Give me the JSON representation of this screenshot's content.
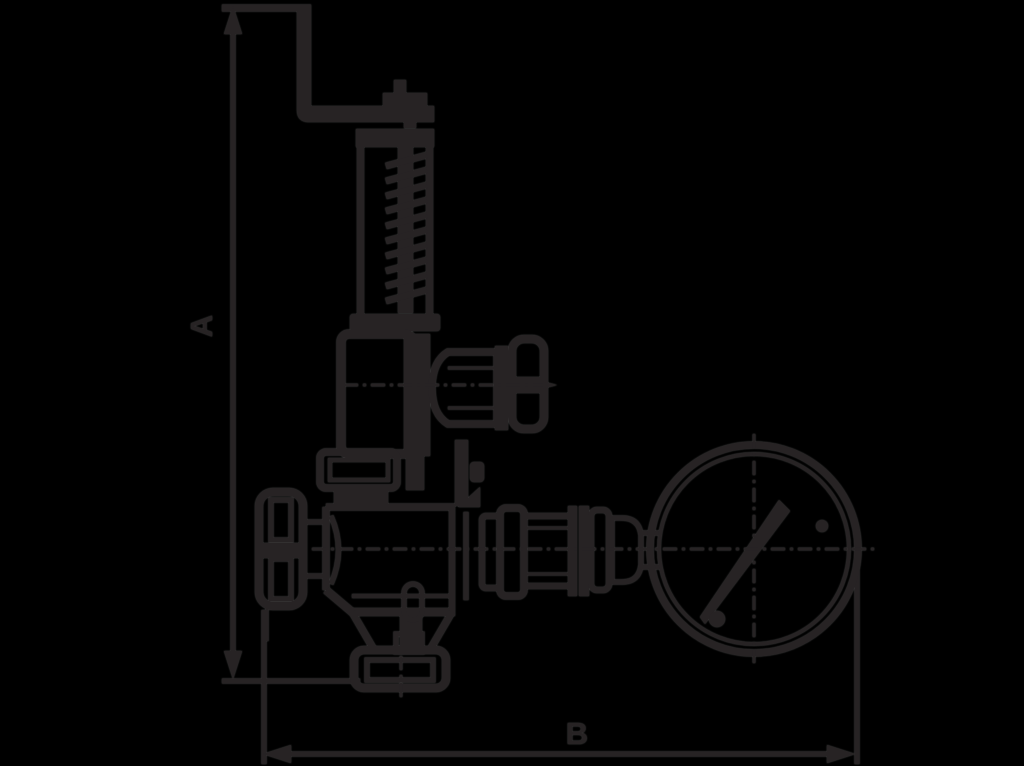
{
  "page": {
    "background_color": "#000000",
    "line_color": "#272324"
  },
  "diagram": {
    "type": "technical-dimension-drawing",
    "description": "Outline drawing of a safety relief valve with lifting lever, side handwheel, bottom outlet flange and pressure gauge, with overall height and width dimension lines",
    "dimensions": {
      "height_label": "A",
      "width_label": "B"
    }
  }
}
